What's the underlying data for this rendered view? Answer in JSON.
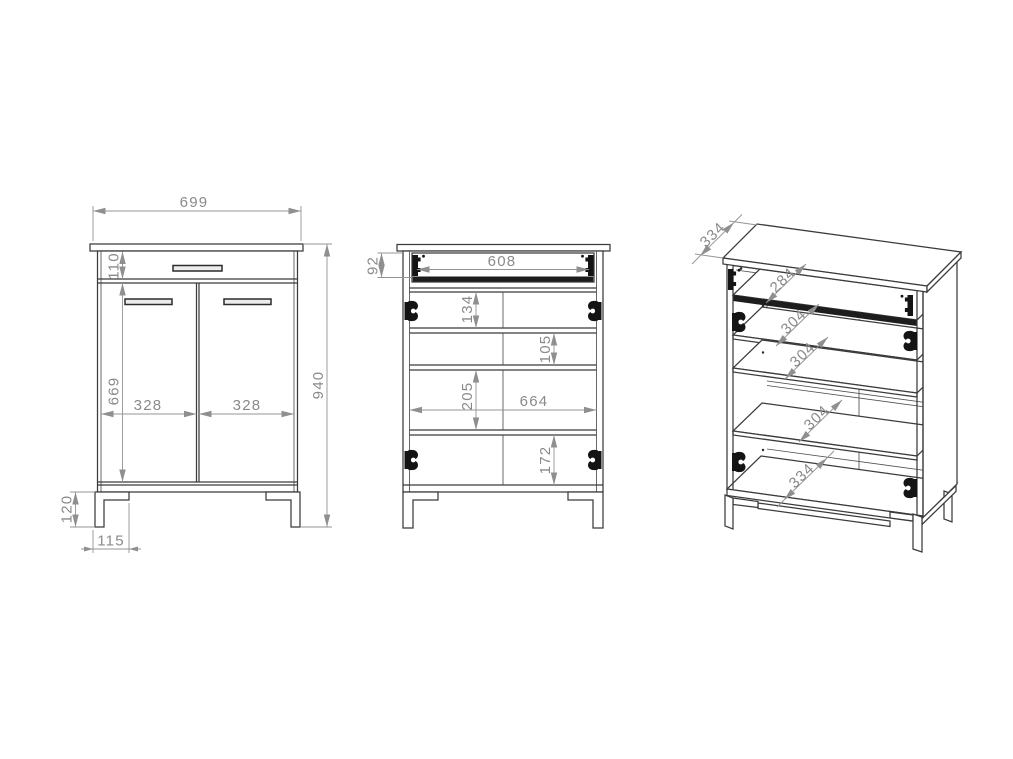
{
  "drawing": {
    "type": "furniture-dimension-drawing",
    "colors": {
      "background": "#ffffff",
      "outline": "#3b3b3b",
      "dimension_lines": "#949494",
      "dimension_text": "#8a8a8a",
      "hardware": "#141414"
    },
    "views": {
      "front": {
        "dims": {
          "width": "699",
          "drawer_height": "110",
          "door_height": "669",
          "left_door_width": "328",
          "right_door_width": "328",
          "total_height": "940",
          "leg_height": "120",
          "leg_inset": "115"
        }
      },
      "open": {
        "dims": {
          "drawer_opening_height": "92",
          "drawer_opening_width": "608",
          "upper_gap": "134",
          "second_gap": "105",
          "third_gap": "205",
          "interior_width": "664",
          "bottom_gap": "172"
        }
      },
      "perspective": {
        "dims": {
          "top_depth": "334",
          "drawer_depth": "284",
          "shelf_depth_1": "304",
          "shelf_depth_2": "304",
          "shelf_depth_3": "304",
          "bottom_depth": "334"
        }
      }
    }
  }
}
